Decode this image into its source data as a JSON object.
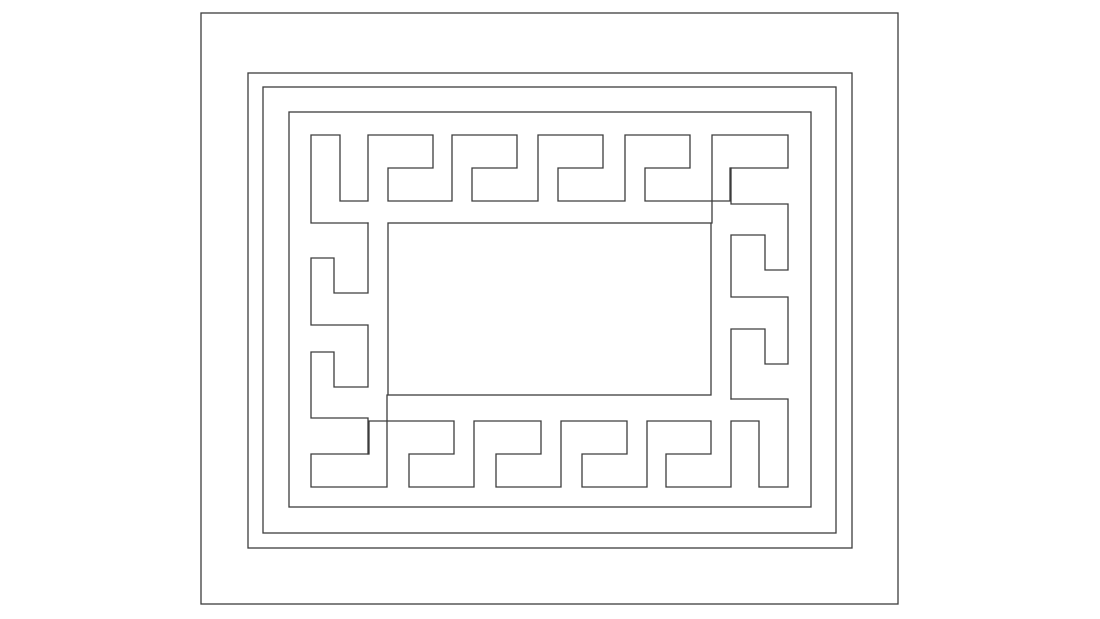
{
  "canvas": {
    "width": 1100,
    "height": 619,
    "background_color": "#ffffff",
    "stroke_color": "#3d3d3d",
    "stroke_width": 1.3
  },
  "drawing": {
    "title": "greek-key-meander-frame-line-art",
    "rectangles": [
      {
        "name": "outer-rectangle",
        "x": 201,
        "y": 13,
        "width": 697,
        "height": 591
      },
      {
        "name": "second-rectangle",
        "x": 248,
        "y": 73,
        "width": 604,
        "height": 475
      },
      {
        "name": "third-rectangle",
        "x": 263,
        "y": 87,
        "width": 573,
        "height": 446
      },
      {
        "name": "fourth-rectangle",
        "x": 289,
        "y": 112,
        "width": 522,
        "height": 395
      },
      {
        "name": "center-rectangle",
        "x": 388,
        "y": 223,
        "width": 323,
        "height": 172
      }
    ],
    "polylines": [
      {
        "name": "meander-top-band",
        "points": [
          [
            368,
            223
          ],
          [
            311,
            223
          ],
          [
            311,
            135
          ],
          [
            340,
            135
          ],
          [
            340,
            201
          ],
          [
            368,
            201
          ],
          [
            368,
            135
          ],
          [
            433,
            135
          ],
          [
            433,
            168
          ],
          [
            388,
            168
          ],
          [
            388,
            201
          ],
          [
            452,
            201
          ],
          [
            452,
            135
          ],
          [
            517,
            135
          ],
          [
            517,
            168
          ],
          [
            472,
            168
          ],
          [
            472,
            201
          ],
          [
            538,
            201
          ],
          [
            538,
            135
          ],
          [
            603,
            135
          ],
          [
            603,
            168
          ],
          [
            558,
            168
          ],
          [
            558,
            201
          ],
          [
            625,
            201
          ],
          [
            625,
            135
          ],
          [
            690,
            135
          ],
          [
            690,
            168
          ],
          [
            645,
            168
          ],
          [
            645,
            201
          ],
          [
            730,
            201
          ],
          [
            730,
            168
          ],
          [
            788,
            168
          ],
          [
            788,
            135
          ],
          [
            712,
            135
          ],
          [
            712,
            223
          ]
        ]
      },
      {
        "name": "meander-left-band",
        "points": [
          [
            368,
            223
          ],
          [
            368,
            293
          ],
          [
            334,
            293
          ],
          [
            334,
            258
          ],
          [
            311,
            258
          ],
          [
            311,
            325
          ],
          [
            368,
            325
          ],
          [
            368,
            387
          ],
          [
            334,
            387
          ],
          [
            334,
            352
          ],
          [
            311,
            352
          ],
          [
            311,
            418
          ],
          [
            368,
            418
          ],
          [
            368,
            454
          ]
        ]
      },
      {
        "name": "meander-bottom-band",
        "points": [
          [
            731,
            399
          ],
          [
            788,
            399
          ],
          [
            788,
            487
          ],
          [
            759,
            487
          ],
          [
            759,
            421
          ],
          [
            731,
            421
          ],
          [
            731,
            487
          ],
          [
            666,
            487
          ],
          [
            666,
            454
          ],
          [
            711,
            454
          ],
          [
            711,
            421
          ],
          [
            647,
            421
          ],
          [
            647,
            487
          ],
          [
            582,
            487
          ],
          [
            582,
            454
          ],
          [
            627,
            454
          ],
          [
            627,
            421
          ],
          [
            561,
            421
          ],
          [
            561,
            487
          ],
          [
            496,
            487
          ],
          [
            496,
            454
          ],
          [
            541,
            454
          ],
          [
            541,
            421
          ],
          [
            474,
            421
          ],
          [
            474,
            487
          ],
          [
            409,
            487
          ],
          [
            409,
            454
          ],
          [
            454,
            454
          ],
          [
            454,
            421
          ],
          [
            369,
            421
          ],
          [
            369,
            454
          ],
          [
            311,
            454
          ],
          [
            311,
            487
          ],
          [
            387,
            487
          ],
          [
            387,
            395
          ]
        ]
      },
      {
        "name": "meander-right-band",
        "points": [
          [
            731,
            399
          ],
          [
            731,
            329
          ],
          [
            765,
            329
          ],
          [
            765,
            364
          ],
          [
            788,
            364
          ],
          [
            788,
            297
          ],
          [
            731,
            297
          ],
          [
            731,
            235
          ],
          [
            765,
            235
          ],
          [
            765,
            270
          ],
          [
            788,
            270
          ],
          [
            788,
            204
          ],
          [
            731,
            204
          ],
          [
            731,
            168
          ]
        ]
      }
    ]
  }
}
